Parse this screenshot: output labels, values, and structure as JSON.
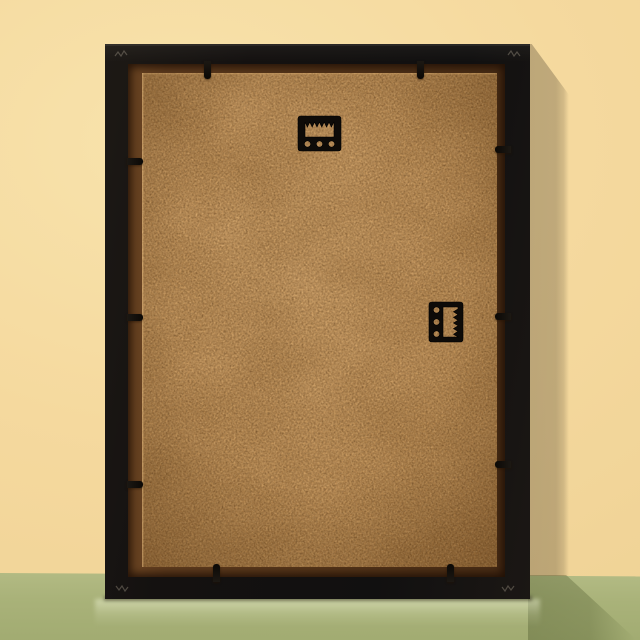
{
  "meta": {
    "description": "Back view of a black picture frame with a tan hardboard backing, leaning against a pale yellow wall on a sage green surface; shadow falls to the right"
  },
  "scene": {
    "wall": {
      "label": "pale yellow wall",
      "color": "#f5d99e"
    },
    "floor": {
      "label": "sage green surface",
      "color": "#a9b279",
      "horizon_y_px": 575
    },
    "shadows": {
      "wall_shadow_color": "#b7a87a",
      "floor_shadow_color": "#8f9e66",
      "direction": "cast to the right of the frame"
    },
    "frame": {
      "label": "picture frame, back side",
      "finish": "matte black",
      "frame_color": "#151210",
      "rabbet_color": "#5e3b1e",
      "backing": {
        "material": "hardboard (MDF) back panel",
        "color": "#c6975e"
      },
      "hardware": {
        "hardware_color": "#0e0b08",
        "sawtooth_hangers": [
          {
            "id": "hanger-portrait",
            "orientation": "horizontal, teeth at top",
            "location": "top center of backing",
            "holes": 3
          },
          {
            "id": "hanger-landscape",
            "orientation": "vertical, teeth at right",
            "location": "right middle of backing",
            "holes": 3
          }
        ],
        "retainer_clips": {
          "count": 10,
          "top_edge": 2,
          "bottom_edge": 2,
          "left_edge": 3,
          "right_edge": 3,
          "color": "#14100c"
        },
        "corner_joint_marks": 4
      }
    }
  }
}
